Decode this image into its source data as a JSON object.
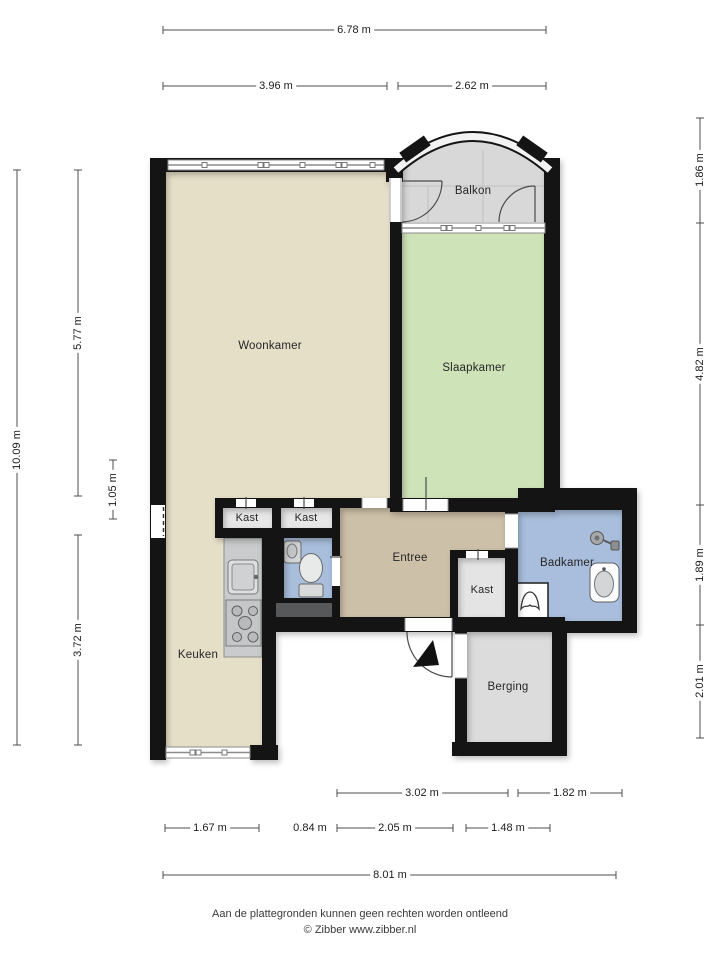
{
  "rooms": {
    "woonkamer": "Woonkamer",
    "slaapkamer": "Slaapkamer",
    "balkon": "Balkon",
    "entree": "Entree",
    "badkamer": "Badkamer",
    "keuken": "Keuken",
    "berging": "Berging",
    "kast1": "Kast",
    "kast2": "Kast",
    "kast3": "Kast"
  },
  "dimensions": {
    "top": {
      "total": "6.78 m",
      "left_section": "3.96 m",
      "right_section": "2.62 m"
    },
    "left": {
      "total": "10.09 m",
      "upper": "5.77 m",
      "middle": "1.05 m",
      "lower": "3.72 m"
    },
    "right": {
      "balkon": "1.86 m",
      "slaapkamer": "4.82 m",
      "badkamer": "1.89 m",
      "berging": "2.01 m"
    },
    "bottom": {
      "entree": "3.02 m",
      "badkamer": "1.82 m",
      "keuken": "1.67 m",
      "opening": "0.84 m",
      "hal": "2.05 m",
      "berging": "1.48 m",
      "total": "8.01 m"
    }
  },
  "footer": {
    "disclaimer": "Aan de plattegronden kunnen geen rechten worden ontleend",
    "credit": "© Zibber www.zibber.nl"
  },
  "colors": {
    "woonkamer": "#e6dfc8",
    "slaapkamer": "#cfe3b8",
    "entree": "#cdc0a8",
    "badkamer": "#a8bedc",
    "balkon": "#d8d8d8",
    "berging": "#dcdcdc",
    "kast": "#e7e7e7",
    "wall": "#141414",
    "counter": "#c9cbcc"
  }
}
